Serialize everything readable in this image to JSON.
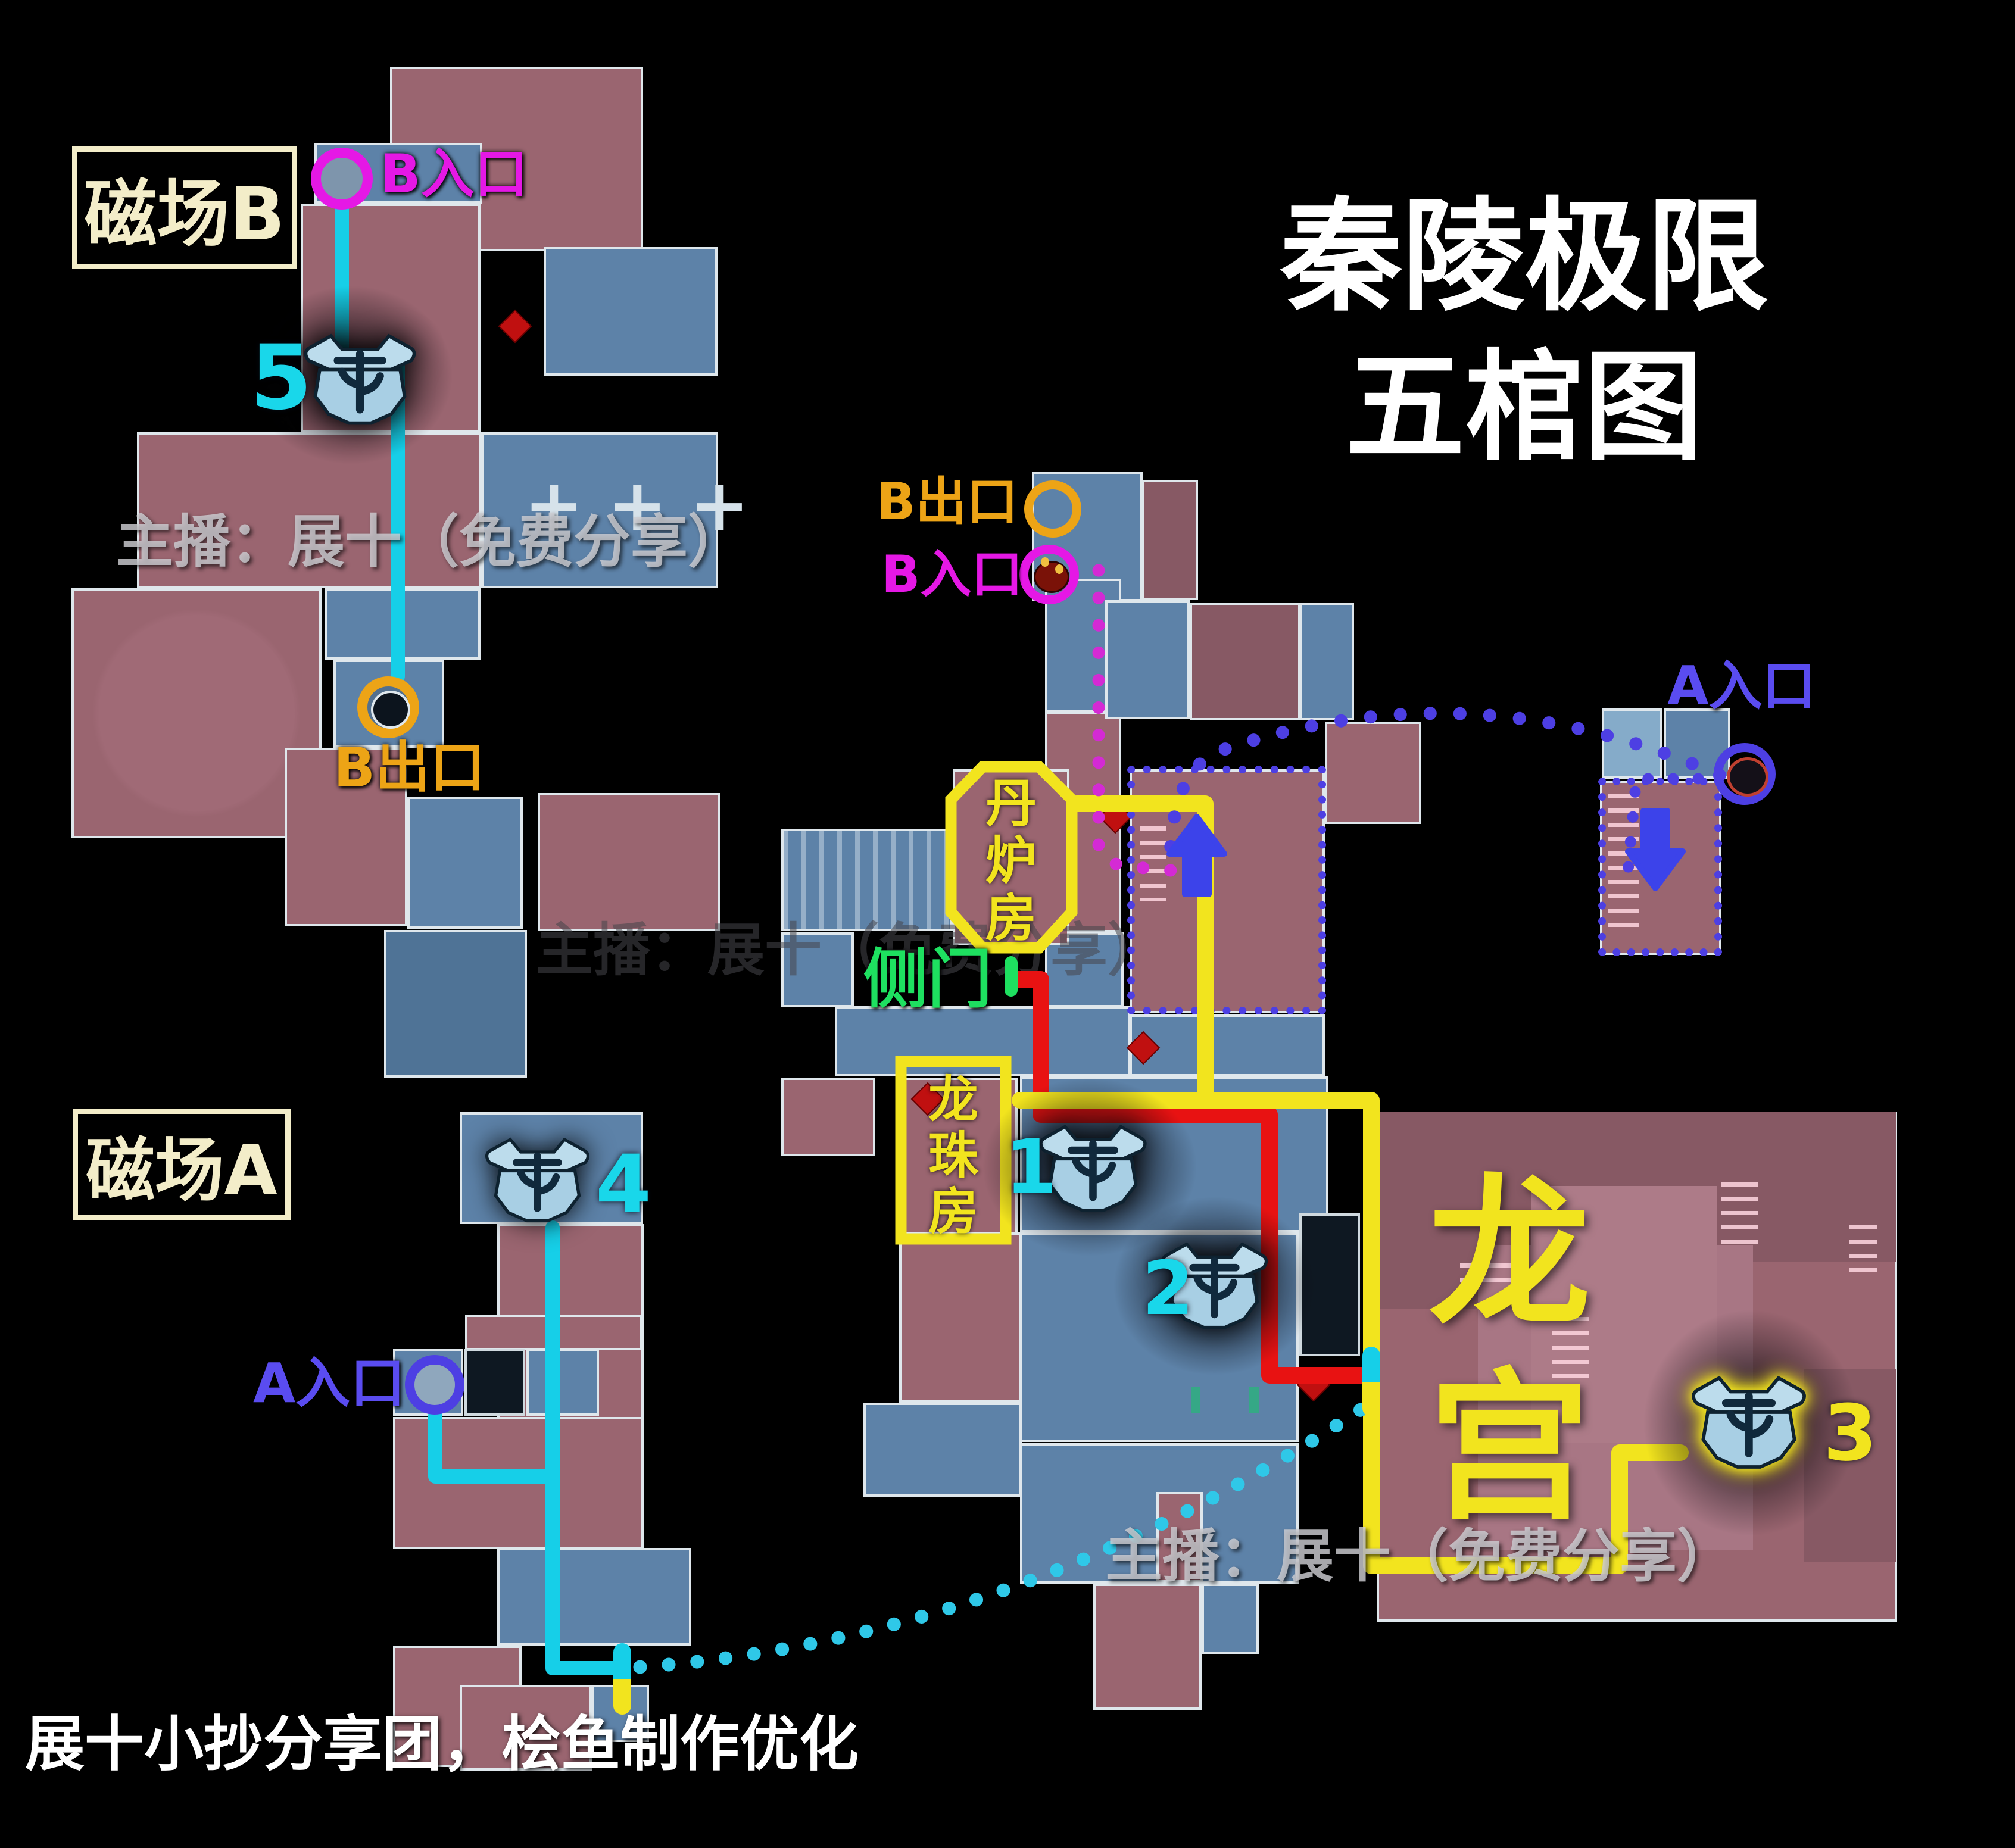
{
  "title": {
    "line1": "秦陵极限",
    "line2": "五棺图"
  },
  "watermark": {
    "top": "主播：展十（免费分享）",
    "middle": "主播：展十（免费分享）",
    "bottom": "主播：展十（免费分享）",
    "credit": "展十小抄分享团，桧鱼制作优化"
  },
  "zones": {
    "field_b": {
      "label": "磁场B",
      "border_color": "#f3edc9"
    },
    "field_a": {
      "label": "磁场A",
      "border_color": "#f3edc9"
    }
  },
  "portals": {
    "b_entrance_top": {
      "label": "B入口",
      "color": "#e518e5"
    },
    "b_exit_top": {
      "label": "B出口",
      "color": "#eda416"
    },
    "b_exit_mid": {
      "label": "B出口",
      "color": "#eda416"
    },
    "b_entrance_mid": {
      "label": "B入口",
      "color": "#e518e5"
    },
    "a_entrance_right": {
      "label": "A入口",
      "color": "#5a4cf0"
    },
    "a_entrance_left": {
      "label": "A入口",
      "color": "#5a4cf0"
    }
  },
  "rooms": {
    "dan_lu_fang": {
      "label": "丹炉房",
      "chars": [
        "丹",
        "炉",
        "房"
      ],
      "color": "#f2e41e"
    },
    "long_zhu_fang": {
      "label": "龙珠房",
      "chars": [
        "龙",
        "珠",
        "房"
      ],
      "color": "#f2e41e"
    },
    "long_gong": {
      "label": "龙宫",
      "chars": [
        "龙",
        "宫"
      ],
      "color": "#f2e41e"
    },
    "side_door": {
      "label": "侧门",
      "color": "#1ee060"
    }
  },
  "coffins": [
    {
      "number": "1",
      "color": "#19d7ea"
    },
    {
      "number": "2",
      "color": "#19d7ea"
    },
    {
      "number": "3",
      "color": "#f2e41e"
    },
    {
      "number": "4",
      "color": "#19d7ea"
    },
    {
      "number": "5",
      "color": "#19d7ea"
    }
  ],
  "routes": {
    "cyan_solid_b": {
      "color": "#16cfe8",
      "style": "solid",
      "desc": "B入口→5号棺→B出口"
    },
    "cyan_solid_a": {
      "color": "#16cfe8",
      "style": "solid",
      "desc": "A入口→4号棺→出口"
    },
    "cyan_dotted": {
      "color": "#2fc8e8",
      "style": "dotted",
      "desc": "磁场A出口→龙宫入口"
    },
    "red": {
      "color": "#e81212",
      "style": "solid",
      "desc": "侧门→1/2号棺→龙宫"
    },
    "yellow": {
      "color": "#f2e41e",
      "style": "solid",
      "desc": "丹炉房→龙宫→3号棺"
    },
    "blue_dotted": {
      "color": "#4d3fe3",
      "style": "dotted",
      "desc": "A入口路线"
    },
    "magenta_dotted": {
      "color": "#d42ad4",
      "style": "dotted",
      "desc": "B入口路线"
    }
  },
  "icons": {
    "coffin": "coffin-chest-icon",
    "up_arrow": "up-arrow-icon",
    "down_arrow": "down-arrow-icon",
    "monster": "monster-face-icon",
    "hole": "tunnel-hole-icon",
    "door_marker": "side-door-marker",
    "capsule": "route-transition-capsule"
  },
  "decor": {
    "cross": "+"
  },
  "map_colors": {
    "background": "#000000",
    "room_pink": "#9a6570",
    "room_blue": "#5d82a8",
    "room_navy": "#0e1822",
    "wall": "#dfe7ec"
  }
}
